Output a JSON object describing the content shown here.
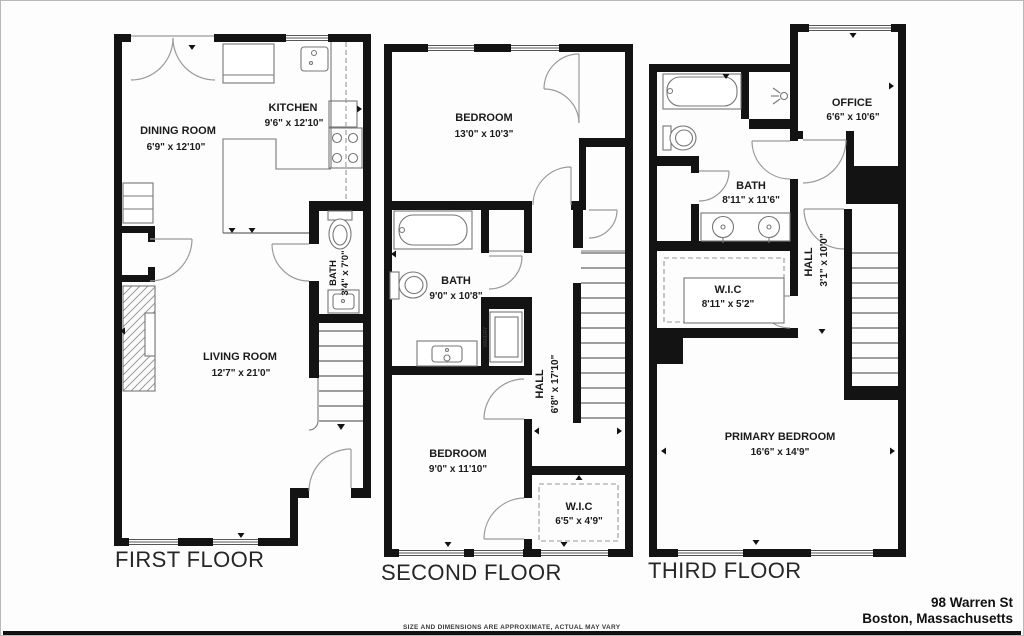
{
  "address": {
    "line1": "98 Warren St",
    "line2": "Boston, Massachusetts"
  },
  "disclaimer": "SIZE AND DIMENSIONS ARE APPROXIMATE, ACTUAL MAY VARY",
  "colors": {
    "wall": "#131313",
    "door_arc": "#9a9a9a",
    "background": "#ffffff"
  },
  "floors": [
    {
      "title": "FIRST FLOOR",
      "rooms": [
        {
          "name": "DINING ROOM",
          "dims": "6'9\" x 12'10\""
        },
        {
          "name": "KITCHEN",
          "dims": "9'6\" x 12'10\""
        },
        {
          "name": "BATH",
          "dims": "3'4\" x 7'0\""
        },
        {
          "name": "LIVING ROOM",
          "dims": "12'7\" x 21'0\""
        }
      ]
    },
    {
      "title": "SECOND FLOOR",
      "rooms": [
        {
          "name": "BEDROOM",
          "dims": "13'0\" x 10'3\""
        },
        {
          "name": "BATH",
          "dims": "9'0\" x 10'8\""
        },
        {
          "name": "HALL",
          "dims": "6'8\" x 17'10\""
        },
        {
          "name": "BEDROOM",
          "dims": "9'0\" x 11'10\""
        },
        {
          "name": "W.I.C",
          "dims": "6'5\" x 4'9\""
        },
        {
          "name": "WM/DRY",
          "dims": ""
        }
      ]
    },
    {
      "title": "THIRD FLOOR",
      "rooms": [
        {
          "name": "BATH",
          "dims": "8'11\" x 11'6\""
        },
        {
          "name": "OFFICE",
          "dims": "6'6\" x 10'6\""
        },
        {
          "name": "HALL",
          "dims": "3'1\" x 10'0\""
        },
        {
          "name": "W.I.C",
          "dims": "8'11\" x 5'2\""
        },
        {
          "name": "PRIMARY BEDROOM",
          "dims": "16'6\" x 14'9\""
        }
      ]
    }
  ]
}
